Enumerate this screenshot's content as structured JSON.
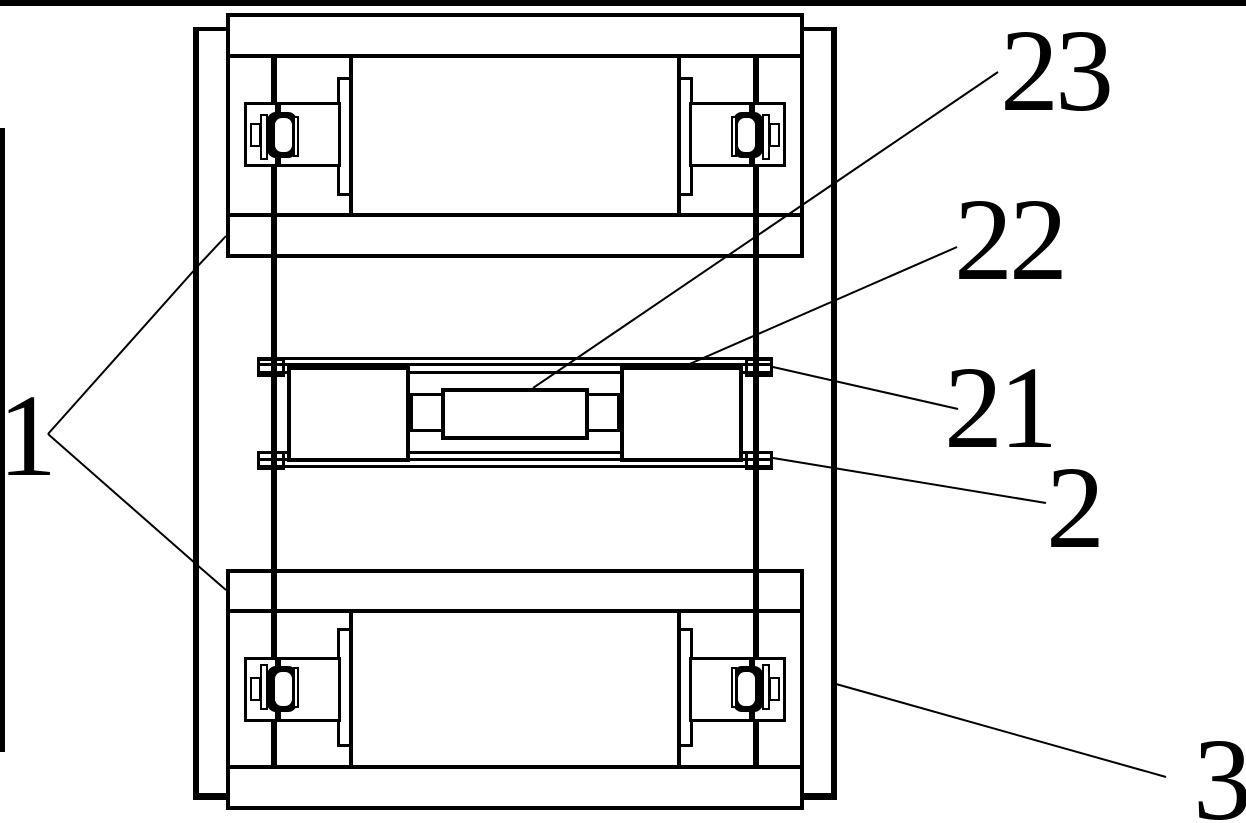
{
  "figure": {
    "kind": "patent technical line drawing (top view of roller carriage assembly)",
    "ink_color": "#000000",
    "paper_color": "#ffffff"
  },
  "labels": {
    "part_1": "1",
    "part_2": "2",
    "part_3": "3",
    "part_21": "21",
    "part_22": "22",
    "part_23": "23"
  }
}
